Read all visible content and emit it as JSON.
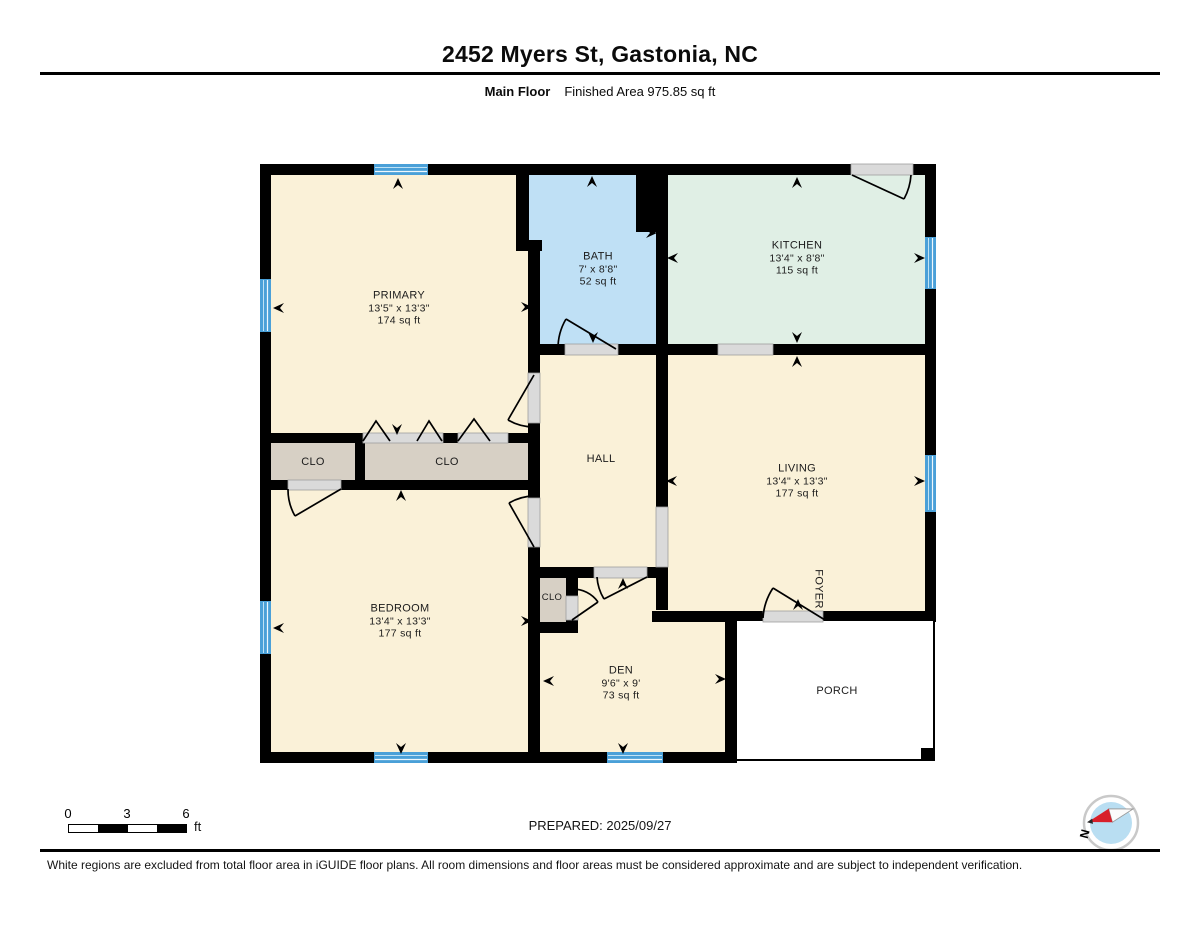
{
  "header": {
    "title": "2452 Myers St, Gastonia, NC",
    "floor_label": "Main Floor",
    "area_label": "Finished Area 975.85 sq ft"
  },
  "rooms": {
    "primary": {
      "name": "PRIMARY",
      "dims": "13'5\" x 13'3\"",
      "area": "174 sq ft"
    },
    "bath": {
      "name": "BATH",
      "dims": "7' x 8'8\"",
      "area": "52 sq ft"
    },
    "kitchen": {
      "name": "KITCHEN",
      "dims": "13'4\" x 8'8\"",
      "area": "115 sq ft"
    },
    "living": {
      "name": "LIVING",
      "dims": "13'4\" x 13'3\"",
      "area": "177 sq ft"
    },
    "hall": {
      "name": "HALL"
    },
    "bedroom": {
      "name": "BEDROOM",
      "dims": "13'4\" x 13'3\"",
      "area": "177 sq ft"
    },
    "den": {
      "name": "DEN",
      "dims": "9'6\" x 9'",
      "area": "73 sq ft"
    },
    "clo_left": {
      "name": "CLO"
    },
    "clo_middle": {
      "name": "CLO"
    },
    "clo_small": {
      "name": "CLO"
    },
    "foyer": {
      "name": "FOYER"
    },
    "porch": {
      "name": "PORCH"
    }
  },
  "scale_bar": {
    "ticks": [
      "0",
      "3",
      "6"
    ],
    "unit": "ft"
  },
  "prepared_label": "PREPARED: 2025/09/27",
  "compass": {
    "north_label": "N"
  },
  "footer": {
    "disclaimer": "White regions are excluded from total floor area in iGUIDE floor plans. All room dimensions and floor areas must be considered approximate and are subject to independent verification."
  },
  "colors": {
    "wall": "#000000",
    "room_fill": "#faf1d8",
    "bath_fill": "#bfe0f5",
    "kitchen_fill": "#e0efe5",
    "closet_fill": "#d7d0c5",
    "window_blue": "#4aa0d8",
    "opening_gray": "#dadada",
    "compass_red": "#d81f2a"
  }
}
